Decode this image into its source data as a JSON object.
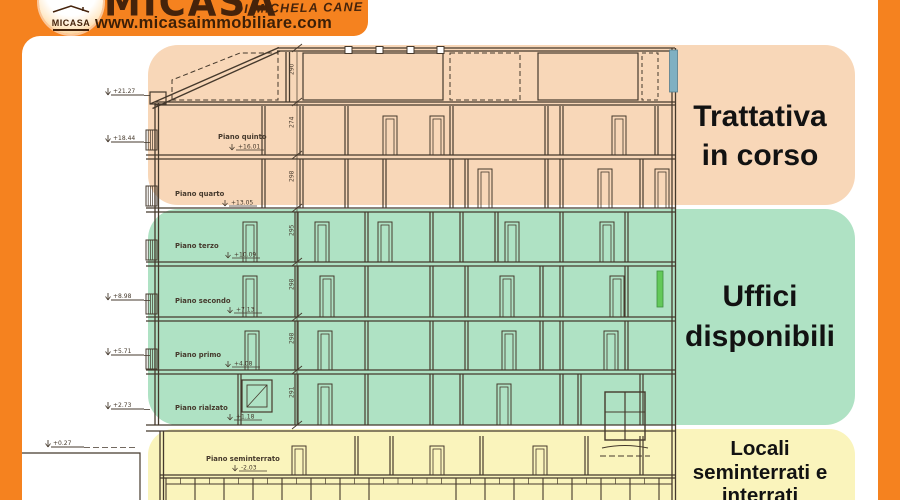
{
  "frame": {
    "color": "#F5821F"
  },
  "header": {
    "brand": "MICASA",
    "brand_sub": "DI MICHELA CANE",
    "website": "www.micasaimmobiliare.com",
    "logo_text": "MICASA"
  },
  "zones": [
    {
      "id": "trattativa",
      "label_lines": [
        "Trattativa",
        "in corso"
      ],
      "color": "#F8D7B8"
    },
    {
      "id": "uffici",
      "label_lines": [
        "Uffici",
        "disponibili"
      ],
      "color": "#AFE2C4"
    },
    {
      "id": "seminterrati",
      "label_lines": [
        "Locali",
        "seminterrati e",
        "interrati"
      ],
      "color": "#FAF4BC"
    }
  ],
  "drawing": {
    "floors": [
      {
        "label": "Piano quinto",
        "elevation": "+16.01"
      },
      {
        "label": "Piano quarto",
        "elevation": "+13.05"
      },
      {
        "label": "Piano terzo",
        "elevation": "+10.09"
      },
      {
        "label": "Piano secondo",
        "elevation": "+7.13"
      },
      {
        "label": "Piano primo",
        "elevation": "+4.08"
      },
      {
        "label": "Piano rialzato",
        "elevation": "+1.18"
      },
      {
        "label": "Piano seminterrato",
        "elevation": "-2.03"
      }
    ],
    "left_markers": [
      "+21.27",
      "+18.44",
      "+8.98",
      "+5.71",
      "+2.73",
      "+0.27"
    ],
    "dim_numbers": [
      "290",
      "274",
      "298",
      "295",
      "298",
      "298",
      "291"
    ],
    "line_color": "#45392C",
    "accents": {
      "teal": "#7FB0C2",
      "lime": "#63C95A"
    }
  }
}
